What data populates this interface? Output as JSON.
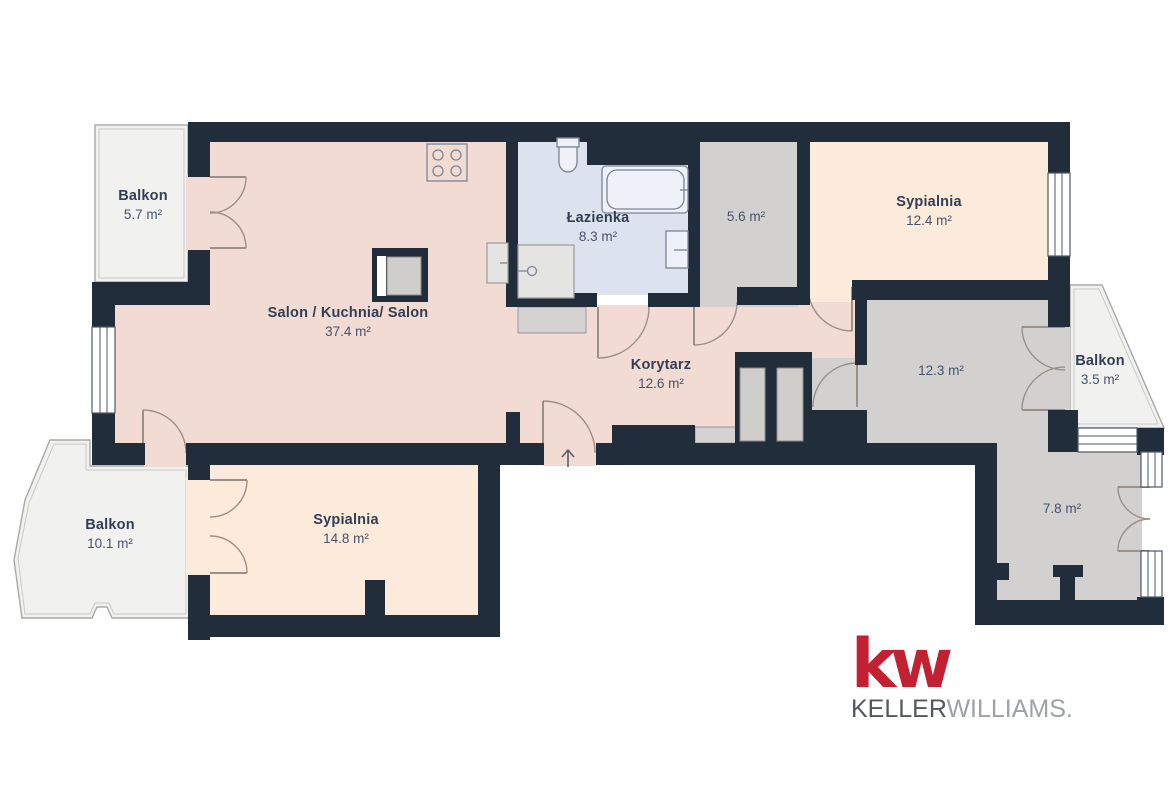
{
  "palette": {
    "wall": "#212d3b",
    "living_area": "#f2dbd2",
    "bedroom": "#fceadb",
    "bathroom": "#dde3ee",
    "utility_gray": "#d2d1cf",
    "balcony": "#f1f1ef",
    "door_arc": "#9a9088",
    "window_frame": "#4e5968",
    "room_name_text": "#323e56",
    "room_area_text": "#46526c",
    "logo_red": "#c32031",
    "logo_gray_dark": "#54585c",
    "logo_gray_light": "#9ea2a5"
  },
  "rooms": [
    {
      "id": "balkon-top-left",
      "name": "Balkon",
      "area": "5.7 m²"
    },
    {
      "id": "salon-kuchnia",
      "name": "Salon / Kuchnia/ Salon",
      "area": "37.4 m²"
    },
    {
      "id": "lazienka",
      "name": "Łazienka",
      "area": "8.3 m²"
    },
    {
      "id": "storage",
      "name": "",
      "area": "5.6 m²"
    },
    {
      "id": "sypialnia-top",
      "name": "Sypialnia",
      "area": "12.4 m²"
    },
    {
      "id": "korytarz",
      "name": "Korytarz",
      "area": "12.6 m²"
    },
    {
      "id": "room-12-3",
      "name": "",
      "area": "12.3 m²"
    },
    {
      "id": "balkon-right",
      "name": "Balkon",
      "area": "3.5 m²"
    },
    {
      "id": "balkon-bottom-left",
      "name": "Balkon",
      "area": "10.1 m²"
    },
    {
      "id": "sypialnia-bottom",
      "name": "Sypialnia",
      "area": "14.8 m²"
    },
    {
      "id": "room-7-8",
      "name": "",
      "area": "7.8 m²"
    }
  ],
  "logo": {
    "mark": "kw",
    "brand_primary": "KELLER",
    "brand_secondary": "WILLIAMS",
    "suffix": "."
  }
}
